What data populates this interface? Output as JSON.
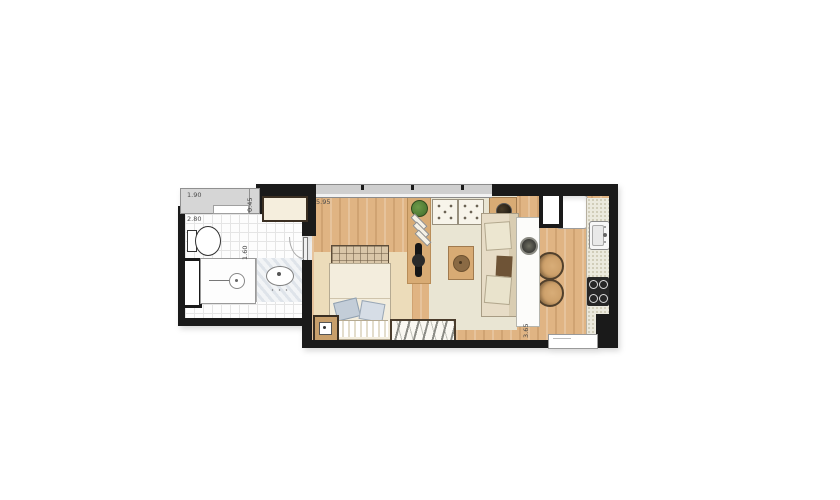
{
  "labels": {
    "planter_width": "1.90",
    "planter_depth": "0.45",
    "bathroom_width": "2.80",
    "shower_width": "1.60",
    "living_width": "5.95",
    "kitchen_length": "3.65"
  },
  "colors": {
    "wall": "#1a1a1a",
    "wood": "#e0b483",
    "wood-trim": "#3b2f22",
    "rug-living": "#e9e5d3",
    "rug-bedroom": "#ecdcba",
    "planter": "#d6d6d6",
    "window-band": "#cfcfcf",
    "counter-stone": "#ebe9dd",
    "cream": "#f5eedd",
    "fabric": "#e7dcc6",
    "pillow-blue": "#c3cdd8",
    "plant-green": "#4e7a33",
    "appliance-dark": "#262626",
    "label": "#4a4a4a"
  }
}
